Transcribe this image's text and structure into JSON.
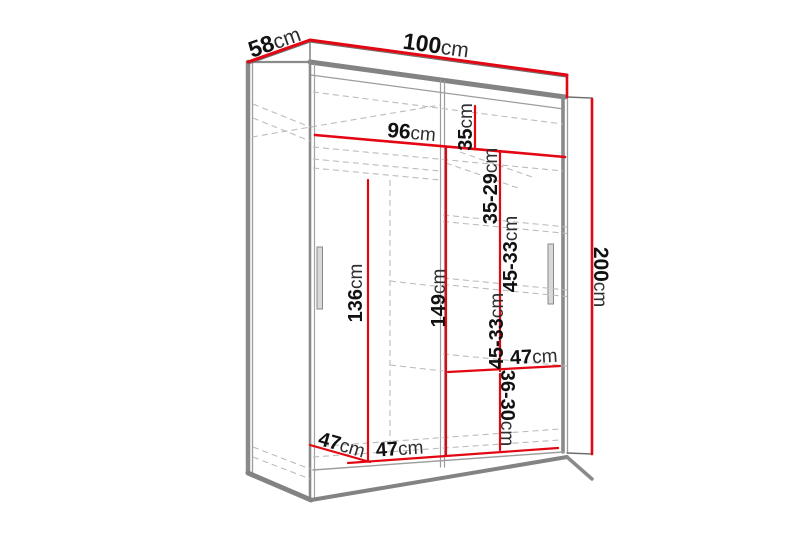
{
  "diagram": {
    "type": "wardrobe-dimension-diagram",
    "unit": "cm",
    "colors": {
      "dimension_line": "#e30613",
      "outline": "#8c8c8c",
      "hidden_line": "#bcbcbc",
      "number_text": "#111111",
      "unit_text": "#2e2e2e"
    },
    "labels": {
      "depth_top": {
        "value": "58",
        "unit": "cm"
      },
      "width_top": {
        "value": "100",
        "unit": "cm"
      },
      "height_right": {
        "value": "200",
        "unit": "cm"
      },
      "interior_width": {
        "value": "96",
        "unit": "cm"
      },
      "top_shelf_height": {
        "value": "35",
        "unit": "cm"
      },
      "upper_shelf_height": {
        "value": "35-29",
        "unit": "cm"
      },
      "middle_shelf_height_a": {
        "value": "45-33",
        "unit": "cm"
      },
      "middle_shelf_height_b": {
        "value": "45-33",
        "unit": "cm"
      },
      "hanging_height": {
        "value": "136",
        "unit": "cm"
      },
      "center_height": {
        "value": "149",
        "unit": "cm"
      },
      "shelf_width_right": {
        "value": "47",
        "unit": "cm"
      },
      "bottom_shelf_height": {
        "value": "36-30",
        "unit": "cm"
      },
      "interior_depth_bottom": {
        "value": "47",
        "unit": "cm"
      },
      "shelf_width_bottom": {
        "value": "47",
        "unit": "cm"
      }
    }
  }
}
